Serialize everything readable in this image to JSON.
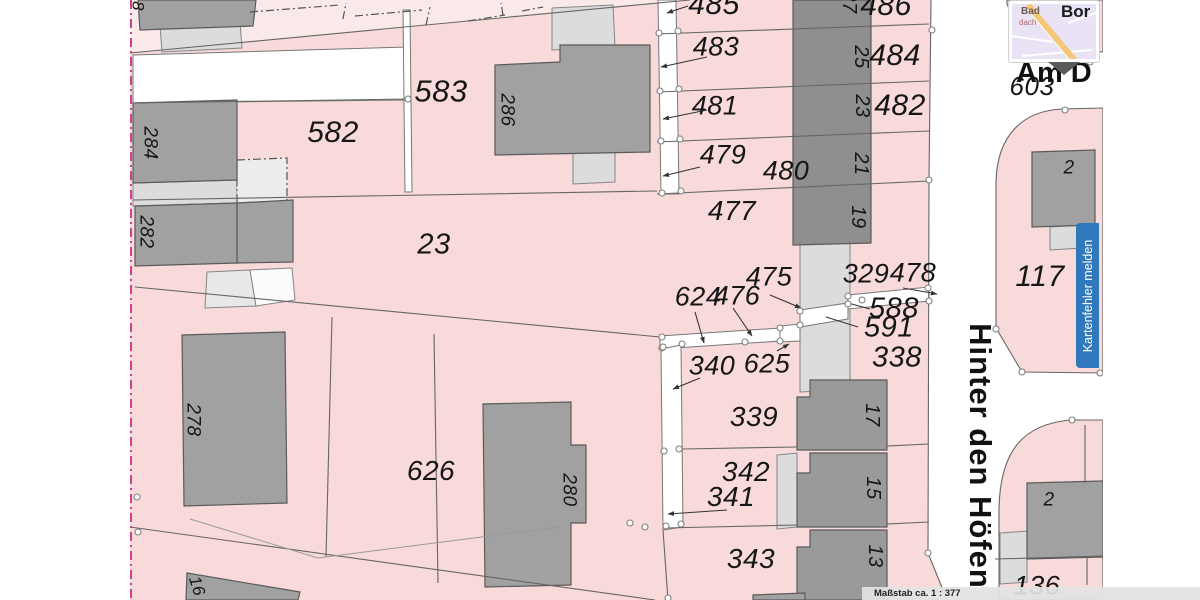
{
  "streets": {
    "vertical": "Hinter den Höfen",
    "horizontal": "Am D"
  },
  "report_button": {
    "label": "Kartenfehler melden",
    "color": "#2e78bb"
  },
  "scale_bar": {
    "label": "Maßstab ca. 1 : 377"
  },
  "popup": {
    "town_small": "Bad",
    "town_partial": "dach",
    "town_large": "Bor"
  },
  "colors": {
    "parcel_pink": "#f8dada",
    "parcel_pale": "#fae9e9",
    "building_dark": "#a1a1a1",
    "building_light": "#dcdcdc",
    "street_white": "#ffffff",
    "boundary": "#666666",
    "map_edge_magenta": "#d0408f",
    "button_blue": "#2e78bb"
  },
  "parcel_labels": [
    {
      "t": "485",
      "x": 714,
      "y": 5,
      "r": 0,
      "s": 30
    },
    {
      "t": "486",
      "x": 886,
      "y": 6,
      "r": 0,
      "s": 30
    },
    {
      "t": "27",
      "x": 849,
      "y": 2,
      "r": 90,
      "s": 20
    },
    {
      "t": "483",
      "x": 716,
      "y": 47,
      "r": 0,
      "s": 27
    },
    {
      "t": "484",
      "x": 895,
      "y": 56,
      "r": 0,
      "s": 30
    },
    {
      "t": "25",
      "x": 861,
      "y": 57,
      "r": 90,
      "s": 20
    },
    {
      "t": "481",
      "x": 715,
      "y": 106,
      "r": 0,
      "s": 27
    },
    {
      "t": "482",
      "x": 900,
      "y": 106,
      "r": 0,
      "s": 30
    },
    {
      "t": "23",
      "x": 862,
      "y": 106,
      "r": 90,
      "s": 20
    },
    {
      "t": "479",
      "x": 723,
      "y": 155,
      "r": 0,
      "s": 27
    },
    {
      "t": "480",
      "x": 786,
      "y": 171,
      "r": 0,
      "s": 27
    },
    {
      "t": "21",
      "x": 861,
      "y": 164,
      "r": 90,
      "s": 20
    },
    {
      "t": "477",
      "x": 732,
      "y": 211,
      "r": 0,
      "s": 28
    },
    {
      "t": "19",
      "x": 858,
      "y": 217,
      "r": 90,
      "s": 20
    },
    {
      "t": "329",
      "x": 866,
      "y": 274,
      "r": 0,
      "s": 27
    },
    {
      "t": "478",
      "x": 913,
      "y": 273,
      "r": 0,
      "s": 27
    },
    {
      "t": "475",
      "x": 769,
      "y": 277,
      "r": 0,
      "s": 27
    },
    {
      "t": "476",
      "x": 737,
      "y": 296,
      "r": 0,
      "s": 27
    },
    {
      "t": "624",
      "x": 698,
      "y": 297,
      "r": 0,
      "s": 27
    },
    {
      "t": "588",
      "x": 894,
      "y": 309,
      "r": 0,
      "s": 29
    },
    {
      "t": "591",
      "x": 889,
      "y": 328,
      "r": 0,
      "s": 29
    },
    {
      "t": "338",
      "x": 897,
      "y": 358,
      "r": 0,
      "s": 29
    },
    {
      "t": "340",
      "x": 712,
      "y": 366,
      "r": 0,
      "s": 27
    },
    {
      "t": "625",
      "x": 767,
      "y": 364,
      "r": 0,
      "s": 27
    },
    {
      "t": "339",
      "x": 754,
      "y": 417,
      "r": 0,
      "s": 28
    },
    {
      "t": "17",
      "x": 872,
      "y": 415,
      "r": 90,
      "s": 20
    },
    {
      "t": "342",
      "x": 746,
      "y": 472,
      "r": 0,
      "s": 28
    },
    {
      "t": "341",
      "x": 731,
      "y": 497,
      "r": 0,
      "s": 28
    },
    {
      "t": "15",
      "x": 873,
      "y": 488,
      "r": 90,
      "s": 20
    },
    {
      "t": "343",
      "x": 751,
      "y": 559,
      "r": 0,
      "s": 28
    },
    {
      "t": "13",
      "x": 875,
      "y": 556,
      "r": 90,
      "s": 20
    },
    {
      "t": "583",
      "x": 441,
      "y": 91,
      "r": 0,
      "s": 31
    },
    {
      "t": "582",
      "x": 333,
      "y": 133,
      "r": 0,
      "s": 30
    },
    {
      "t": "23",
      "x": 434,
      "y": 245,
      "r": 0,
      "s": 29
    },
    {
      "t": "626",
      "x": 431,
      "y": 471,
      "r": 0,
      "s": 28
    },
    {
      "t": "284",
      "x": 150,
      "y": 143,
      "r": 90,
      "s": 19
    },
    {
      "t": "282",
      "x": 146,
      "y": 232,
      "r": 90,
      "s": 19
    },
    {
      "t": "8",
      "x": 138,
      "y": 6,
      "r": 90,
      "s": 17
    },
    {
      "t": "286",
      "x": 507,
      "y": 110,
      "r": 90,
      "s": 19
    },
    {
      "t": "278",
      "x": 193,
      "y": 420,
      "r": 90,
      "s": 19
    },
    {
      "t": "280",
      "x": 569,
      "y": 490,
      "r": 90,
      "s": 19
    },
    {
      "t": "16",
      "x": 197,
      "y": 586,
      "r": 72,
      "s": 17
    },
    {
      "t": "117",
      "x": 1040,
      "y": 277,
      "r": 0,
      "s": 30
    },
    {
      "t": "603",
      "x": 1032,
      "y": 86,
      "r": 0,
      "s": 26
    },
    {
      "t": "2",
      "x": 1069,
      "y": 168,
      "r": 0,
      "s": 19
    },
    {
      "t": "2",
      "x": 1049,
      "y": 500,
      "r": 0,
      "s": 19
    },
    {
      "t": "136",
      "x": 1037,
      "y": 586,
      "r": 0,
      "s": 27
    }
  ]
}
